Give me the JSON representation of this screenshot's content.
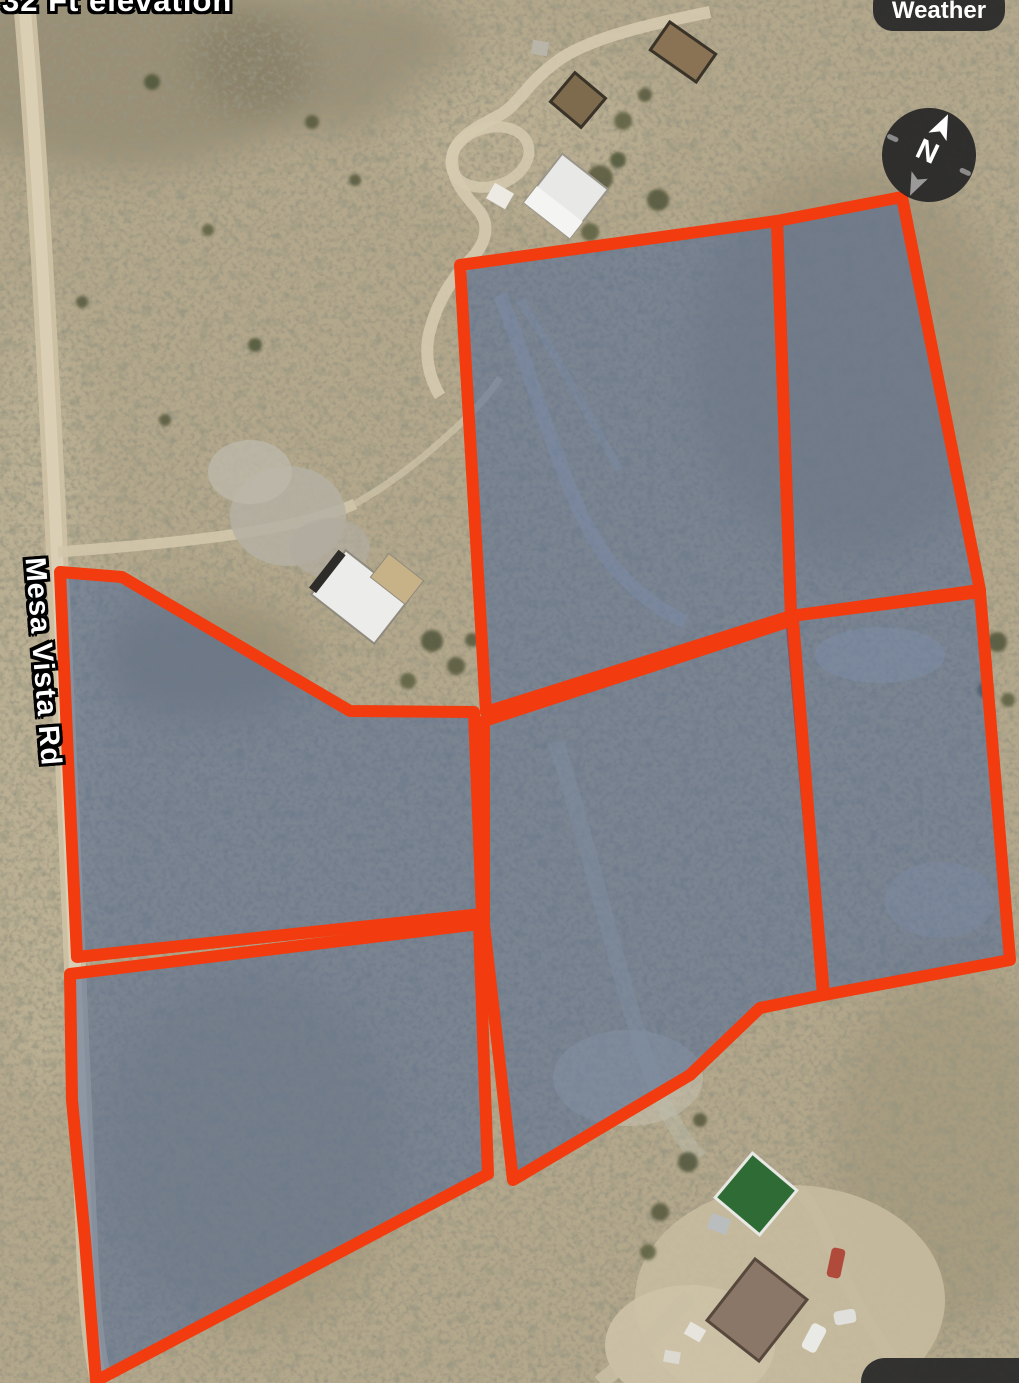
{
  "overlay": {
    "elevation_label": "32 Ft elevation",
    "weather_button_label": "Weather",
    "road_label": "Mesa Vista Rd",
    "compass_north_label": "N"
  },
  "map": {
    "annotation_color": "#f23b0f",
    "parcel_fill_color": "rgba(65,96,150,0.5)",
    "parcel_stroke_width": 12,
    "compass_rotation_deg": 25,
    "parcels": [
      {
        "id": "parcel-upper-middle",
        "points": "460,265 777,221 791,616 486,712"
      },
      {
        "id": "parcel-upper-right",
        "points": "777,221 902,197 980,590 791,616"
      },
      {
        "id": "parcel-middle-right",
        "points": "791,616 980,592 1010,960 824,995"
      },
      {
        "id": "parcel-center",
        "points": "484,721 793,620 823,995 760,1008 690,1075 513,1180 484,925"
      },
      {
        "id": "parcel-upper-left",
        "points": "60,572 122,577 350,711 474,712 482,914 77,957 68,760"
      },
      {
        "id": "parcel-lower-left",
        "points": "70,974 479,924 488,1174 96,1381 85,1240 72,1100"
      }
    ]
  }
}
